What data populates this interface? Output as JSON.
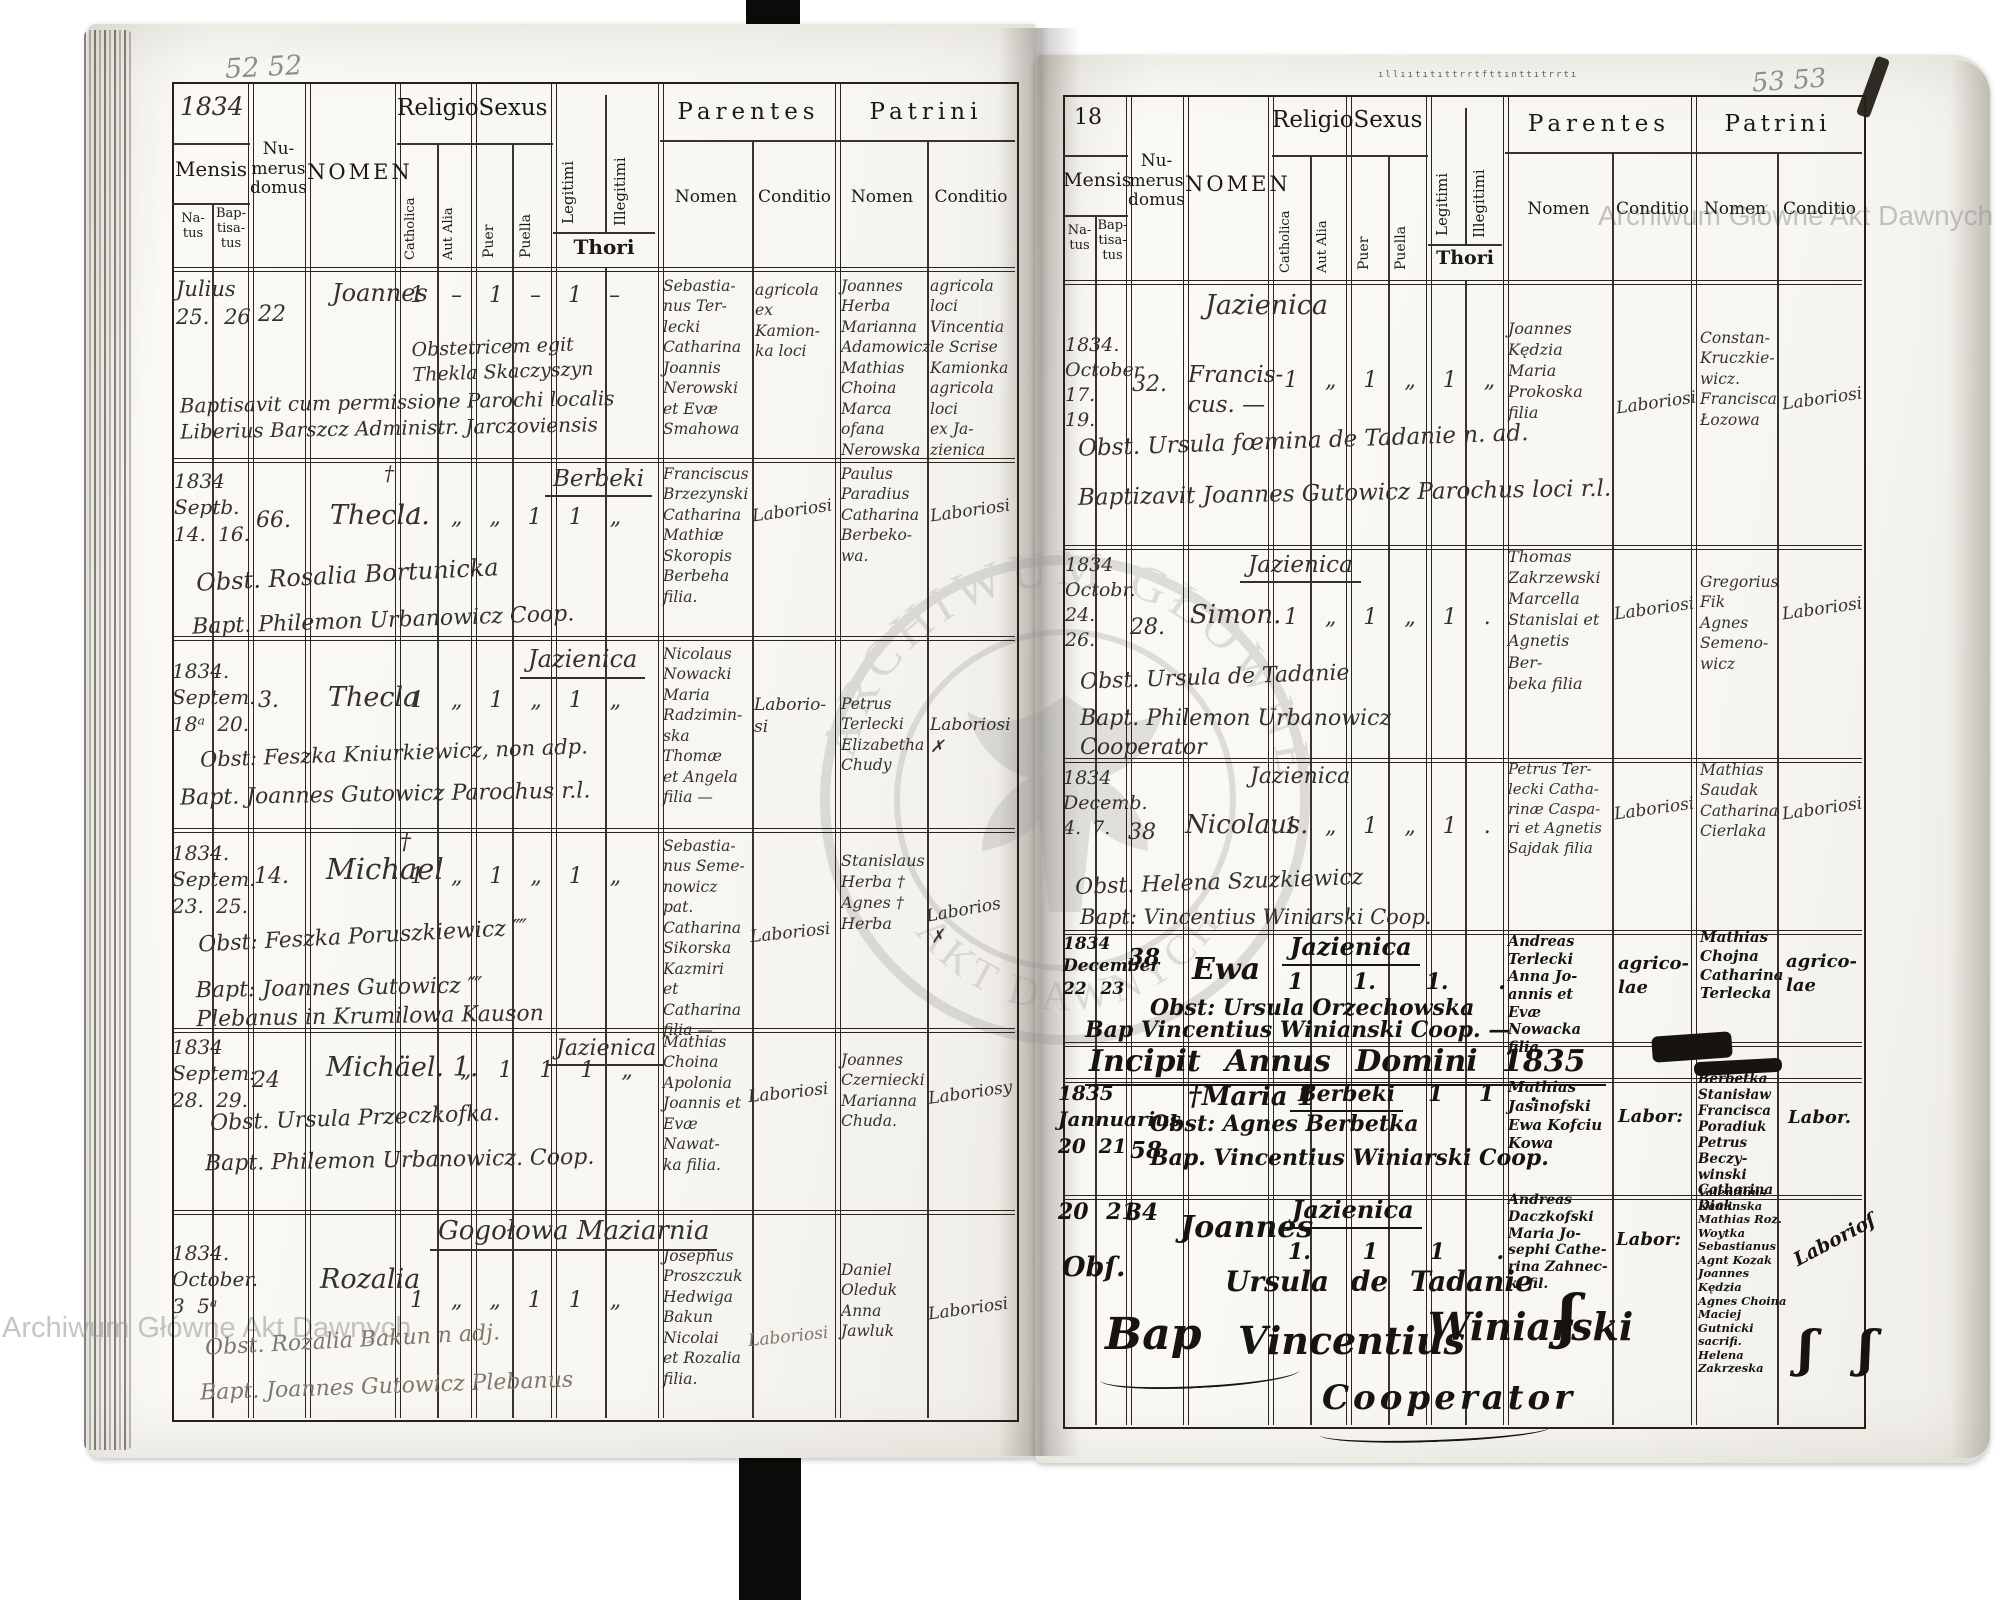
{
  "watermark": {
    "corner": "Archiwum Główne Akt Dawnych",
    "arc_top": "ARCHIWUM GŁÓWNE",
    "arc_bottom": "AKT DAWNYCH"
  },
  "header": {
    "mensis": "Mensis",
    "natus": "Na-\ntus",
    "baptisatus": "Bap-\ntisa-\ntus",
    "numerus": "Nu-\nmerus\ndomus",
    "nomen": "NOMEN",
    "religio": "Religio",
    "catholica": "Catholica",
    "aut_alia": "Aut Alia",
    "sexus": "Sexus",
    "puer": "Puer",
    "puella": "Puella",
    "legitimi": "Legitimi",
    "illegitimi": "Illegitimi",
    "thori": "Thori",
    "parentes": "Parentes",
    "patrini": "Patrini",
    "sub_nomen": "Nomen",
    "sub_conditio": "Conditio"
  },
  "left_page": {
    "pencil": "52 52",
    "year": "1834",
    "entries": [
      {
        "date": "Julius\n25.  26",
        "house": "22",
        "name": "Joannes",
        "name_mark": "",
        "place": "",
        "marks": "1 – 1 – 1 –",
        "obst": "Obstetricem egit\nThekla Skaczyszyn",
        "bapt": "Baptisavit cum permissione Parochi localis\nLiberius Barszcz Administr. Jarczoviensis",
        "par_nomen": "Sebastia-\nnus Ter-\nlecki\nCatharina\nJoannis\nNerowski\net Evæ\nSmahowa",
        "par_cond": "agricola\nex Kamion-\nka loci",
        "pat_nomen": "Joannes\nHerba\nMarianna\nAdamowicz\nMathias\nChoina\nMarca ofana\nNerowska",
        "pat_cond": "agricola\nloci\nVincentia\nle Scrise\nKamionka\nagricola loci\nex Ja-\nzienica"
      },
      {
        "date": "1834\nSeptb.\n14. 16.",
        "house": "66.",
        "name": "Thecla.",
        "name_mark": "†",
        "place": "Berbeki",
        "marks": "1 „ „ 1 1 „",
        "obst": "Obst. Rosalia Bortunicka",
        "bapt": "Bapt. Philemon Urbanowicz Coop.",
        "par_nomen": "Franciscus\nBrzezynski\nCatharina\nMathiæ\nSkoropis\nBerbeha\nfilia.",
        "par_cond": "Laboriosi",
        "pat_nomen": "Paulus\nParadius\nCatharina\nBerbeko-\nwa.",
        "pat_cond": "Laboriosi"
      },
      {
        "date": "1834.\nSeptem.\n18ᵃ 20.",
        "house": "3.",
        "name": "Thecla",
        "name_mark": "",
        "place": "Jazienica",
        "marks": "1 „ 1 „ 1 „",
        "obst": "Obst: Feszka Kniurkiewicz, non adp.",
        "bapt": "Bapt. Joannes Gutowicz Parochus r.l.",
        "par_nomen": "Nicolaus\nNowacki\nMaria\nRadzimin-\nska Thomæ\net Angela\nfilia —",
        "par_cond": "Laborio-\nsi",
        "pat_nomen": "Petrus\nTerlecki\nElizabetha\nChudy",
        "pat_cond": "Laboriosi\n✗"
      },
      {
        "date": "1834.\nSeptem.\n23. 25.",
        "house": "14.",
        "name": "Michael",
        "name_mark": "†",
        "place": "",
        "marks": "1 „ 1 „ 1 „",
        "obst": "Obst: Feszka Poruszkiewicz ⁗",
        "bapt": "Bapt: Joannes Gutowicz ⁗\nPlebanus in Krumilowa Kauson",
        "par_nomen": "Sebastia-\nnus Seme-\nnowicz pat.\nCatharina\nSikorska\nKazmiri\net Catharina\nfilia —",
        "par_cond": "Laboriosi",
        "pat_nomen": "Stanislaus\nHerba †\nAgnes †\nHerba",
        "pat_cond": "Laborios\n✗"
      },
      {
        "date": "1834\nSeptem:\n28. 29.",
        "house": "24",
        "name": "Michäel. 1.",
        "name_mark": "",
        "place": "Jazienica",
        "marks": "„ 1 1 1 „",
        "obst": "Obst. Ursula Przeczkofka.",
        "bapt": "Bapt. Philemon Urbanowicz. Coop.",
        "par_nomen": "Mathias\nChoina\nApolonia\nJoannis et\nEvæ Nawat-\nka filia.",
        "par_cond": "Laboriosi",
        "pat_nomen": "Joannes\nCzerniecki\nMarianna\nChuda.",
        "pat_cond": "Laboriosy"
      },
      {
        "date": "1834.\nOctober.\n3  5ᵃ",
        "house": "",
        "name": "Rozalia",
        "name_mark": "",
        "place": "Gogołowa Maziarnia",
        "marks": "1 „ „ 1 1 „",
        "obst": "Obst. Rozalia Bakun n adj.",
        "bapt": "Bapt. Joannes Gutowicz Plebanus",
        "par_nomen": "Josephus\nProszczuk\nHedwiga\nBakun\nNicolai\net Rozalia\nfilia.",
        "par_cond": "Laboriosi",
        "pat_nomen": "Daniel\nOleduk\nAnna\nJawluk",
        "pat_cond": "Laboriosi"
      }
    ]
  },
  "right_page": {
    "pencil": "53 53",
    "year": "18",
    "stamp": "ıllııtıtıttrrtfttınttıtrrtı",
    "incipit": "Incipit Annus Domini 1835",
    "closing_line1": "Bap",
    "closing_line2": "Vincentius",
    "closing_line3": "Winiarski",
    "closing_line4": "Cooperator",
    "flourish": "ʃ",
    "flourish2": "ʃ   ʃ",
    "entries": [
      {
        "date": "1834.\nOctober\n17. 19.",
        "house": "32.",
        "name": "Francis-\ncus. —",
        "place": "Jazienica",
        "marks": "1 „ 1 „ 1 „",
        "obst": "Obst. Ursula fœmina de Tadanie n. ad.",
        "bapt": "Baptizavit Joannes Gutowicz Parochus loci r.l.",
        "par_nomen": "Joannes\nKędzia\nMaria\nProkoska\nfilia",
        "par_cond": "Laboriosi",
        "pat_nomen": "Constan-\nKruczkie-\nwicz.\nFrancisca\nŁozowa",
        "pat_cond": "Laboriosi"
      },
      {
        "date": "1834\nOctobr.\n24. 26.",
        "house": "28.",
        "name": "Simon.",
        "place": "Jazienica",
        "marks": "1 „ 1 „ 1 .",
        "obst": "Obst. Ursula de Tadanie",
        "bapt": "Bapt. Philemon Urbanowicz\nCooperator",
        "par_nomen": "Thomas\nZakrzewski\nMarcella\nStanislai et\nAgnetis Ber-\nbeka filia",
        "par_cond": "Laboriosi",
        "pat_nomen": "Gregorius\nFik\nAgnes\nSemeno-\nwicz",
        "pat_cond": "Laboriosi"
      },
      {
        "date": "1834\nDecemb.\n4.  7.",
        "house": "38",
        "name": "Nicolaus.",
        "place": "Jazienica",
        "marks": "1 „ 1 „ 1 .",
        "obst": "Obst. Helena Szuzkiewicz",
        "bapt": "Bapt: Vincentius Winiarski Coop.",
        "par_nomen": "Petrus Ter-\nlecki Catha-\nrinæ Caspa-\nri et Agnetis\nSajdak filia",
        "par_cond": "Laboriosi",
        "pat_nomen": "Mathias\nSaudak\nCatharina\nCierlaka",
        "pat_cond": "Laboriosi"
      },
      {
        "date": "1834\nDecember\n22    23",
        "house": "38",
        "name": "Ewa",
        "place": "Jazienica",
        "marks": "1 1. 1. .",
        "obst": "Obst: Ursula  Orzechowska",
        "bapt": "Bap  Vincentius  Winianski  Coop.   —",
        "par_nomen": "Andreas\nTerlecki\nAnna Jo-\nannis et Evæ\nNowacka\nfilia",
        "par_cond": "agrico-\nlae",
        "pat_nomen": "Mathias\nChojna\nCatharina\nTerlecka",
        "pat_cond": "agrico-\nlae"
      },
      {
        "date": "1835\nJannuarius\n20   21",
        "house": "58",
        "name": "†Maria 1",
        "place": "Berbeki",
        "marks": "1 1 .",
        "obst": "Obst: Agnes Berbetka",
        "bapt": "Bap. Vincentius Winiarski Coop.",
        "par_nomen": "Mathias\nJasinofski\nEwa Kofciu\nKowa",
        "par_cond": "Labor:",
        "pat_nomen": "Berbetka\nStanisław\nFrancisca\nPoradiuk\nPetrus Beczy-\nwinski\nCatharina\nDiak",
        "pat_cond": "Labor."
      },
      {
        "date": "20   21",
        "house": "34",
        "name": "Joannes",
        "place": "Jazienica",
        "marks": "1. 1 1 .",
        "obst": "Obſ.",
        "obst2": "Ursula  de  Tadanie",
        "bapt": "",
        "par_nomen": "Andreas\nDaczkofski\nMaria Jo-\nsephi Cathe-\nrina Zahnec-\nki fil.",
        "par_cond": "Labor:",
        "pat_nomen": "Valentinus\nKaminska\nMathias Roz.\nWoytka\nSebastianus\nAgnt Kozak\nJoannes Kędzia\nAgnes Choina\nMaciej Gutnicki sacrifi.\nHelena Zakrzeska",
        "pat_cond": "Laborioſ"
      }
    ]
  }
}
